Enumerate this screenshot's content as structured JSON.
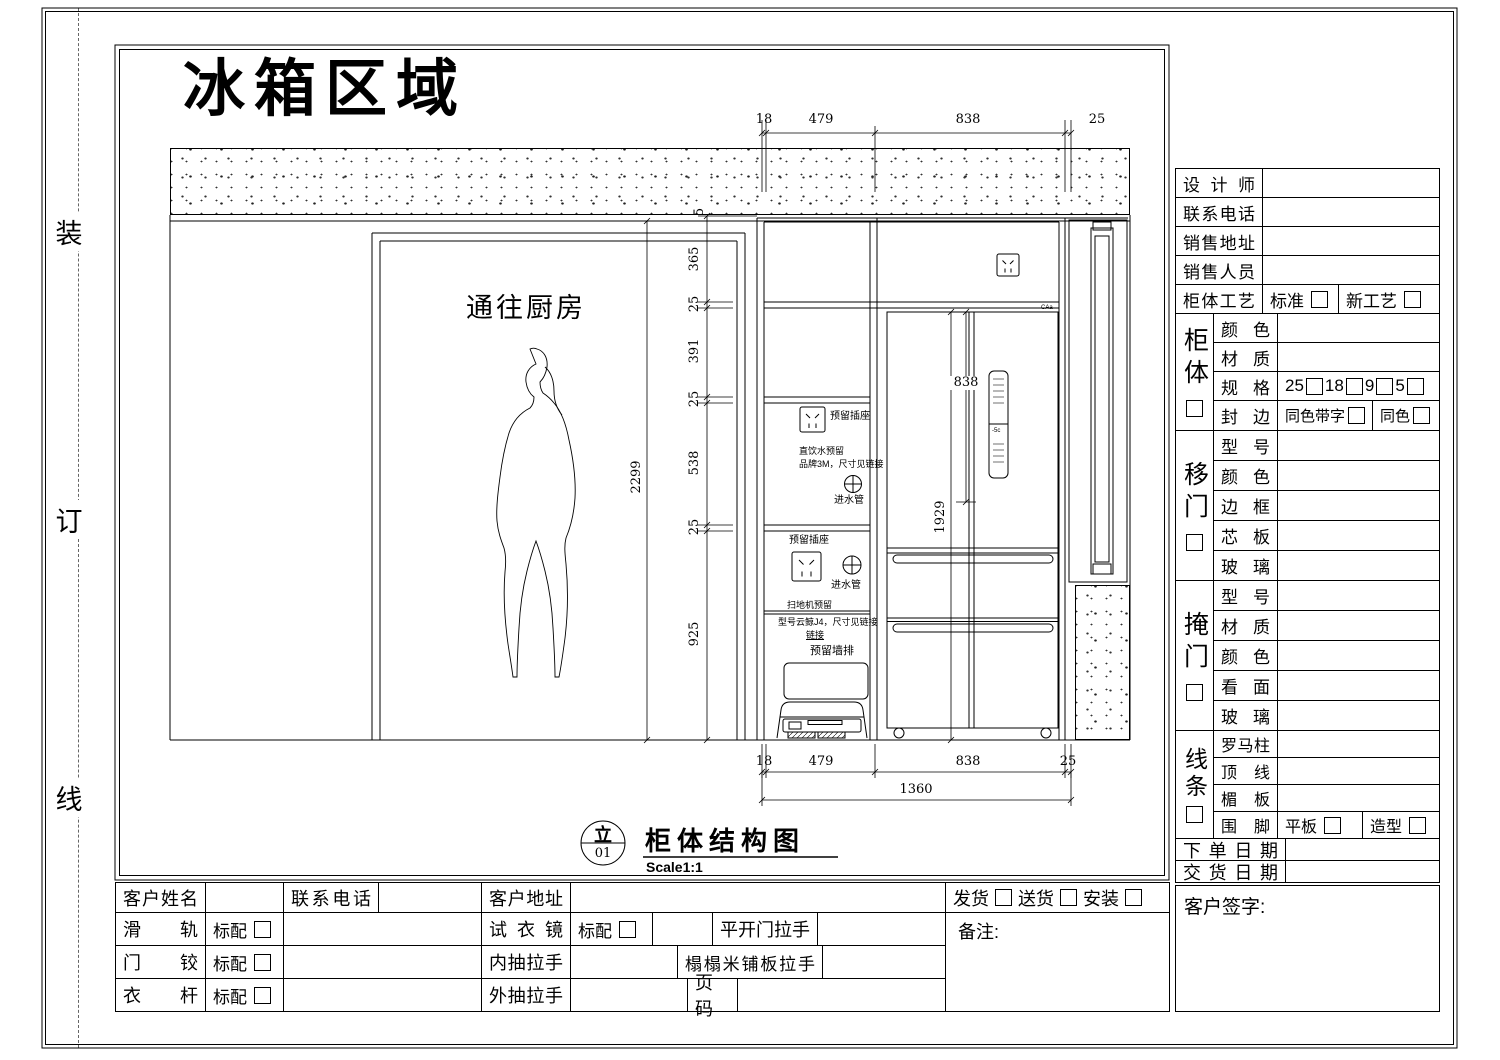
{
  "sheet": {
    "title": "冰箱区域",
    "binding_marks": [
      "装",
      "订",
      "线"
    ]
  },
  "drawing": {
    "door_label": "通往厨房",
    "caption": {
      "tag_top": "立",
      "tag_no": "01",
      "title": "柜体结构图",
      "scale": "Scale1:1"
    },
    "fridge": {
      "brand": "CAa",
      "display": "-5c"
    },
    "dims": {
      "top": [
        "18",
        "479",
        "838",
        "25"
      ],
      "bottom": [
        "18",
        "479",
        "838",
        "25"
      ],
      "bottom_total": "1360",
      "left_chain": [
        "5",
        "365",
        "25",
        "391",
        "25",
        "538",
        "25",
        "925"
      ],
      "door_height": "2299",
      "fridge_upper": "838",
      "fridge_total": "1929"
    },
    "notes": {
      "socket_upper": "预留插座",
      "water_line1": "直饮水预留",
      "water_line2": "品牌3M，尺寸见链接",
      "inlet_upper": "进水管",
      "socket_lower": "预留插座",
      "inlet_lower": "进水管",
      "vacuum_line1": "扫地机预留",
      "vacuum_line2": "型号云鲸J4，尺寸见链接",
      "vacuum_link": "链接",
      "wall_drain": "预留墙排"
    }
  },
  "form": {
    "rows_top": [
      {
        "label": "设计师"
      },
      {
        "label": "联系电话"
      },
      {
        "label": "销售地址"
      },
      {
        "label": "销售人员"
      }
    ],
    "craft": {
      "label": "柜体工艺",
      "opt1": "标准",
      "opt2": "新工艺"
    },
    "cabinet": {
      "name": "柜体",
      "color": "颜色",
      "material": "材质",
      "spec": "规格",
      "spec_opts": [
        "25",
        "18",
        "9",
        "5"
      ],
      "edge": "封边",
      "edge_opt1": "同色带字",
      "edge_opt2": "同色"
    },
    "sliding": {
      "name": "移门",
      "rows": [
        "型号",
        "颜色",
        "边框",
        "芯板",
        "玻璃"
      ]
    },
    "hinged": {
      "name": "掩门",
      "rows": [
        "型号",
        "材质",
        "颜色",
        "看面",
        "玻璃"
      ]
    },
    "trim": {
      "name": "线条",
      "rows": [
        "罗马柱",
        "顶线",
        "楣板"
      ],
      "foot": "围脚",
      "foot_opt1": "平板",
      "foot_opt2": "造型"
    },
    "order_date": "下单日期",
    "delivery_date": "交货日期",
    "signature": "客户签字:"
  },
  "order_table": {
    "r1": {
      "c1": "客户姓名",
      "c2": "联系电话",
      "c3": "客户地址"
    },
    "r2": {
      "c1": "滑轨",
      "std": "标配",
      "c2": "试衣镜",
      "std2": "标配",
      "c3": "平开门拉手"
    },
    "r3": {
      "c1": "门铰",
      "std": "标配",
      "c2": "内抽拉手",
      "c3": "榻榻米铺板拉手"
    },
    "r4": {
      "c1": "衣杆",
      "std": "标配",
      "c2": "外抽拉手",
      "c3": "页码"
    },
    "ship": {
      "o1": "发货",
      "o2": "送货",
      "o3": "安装"
    },
    "notes": "备注:"
  }
}
